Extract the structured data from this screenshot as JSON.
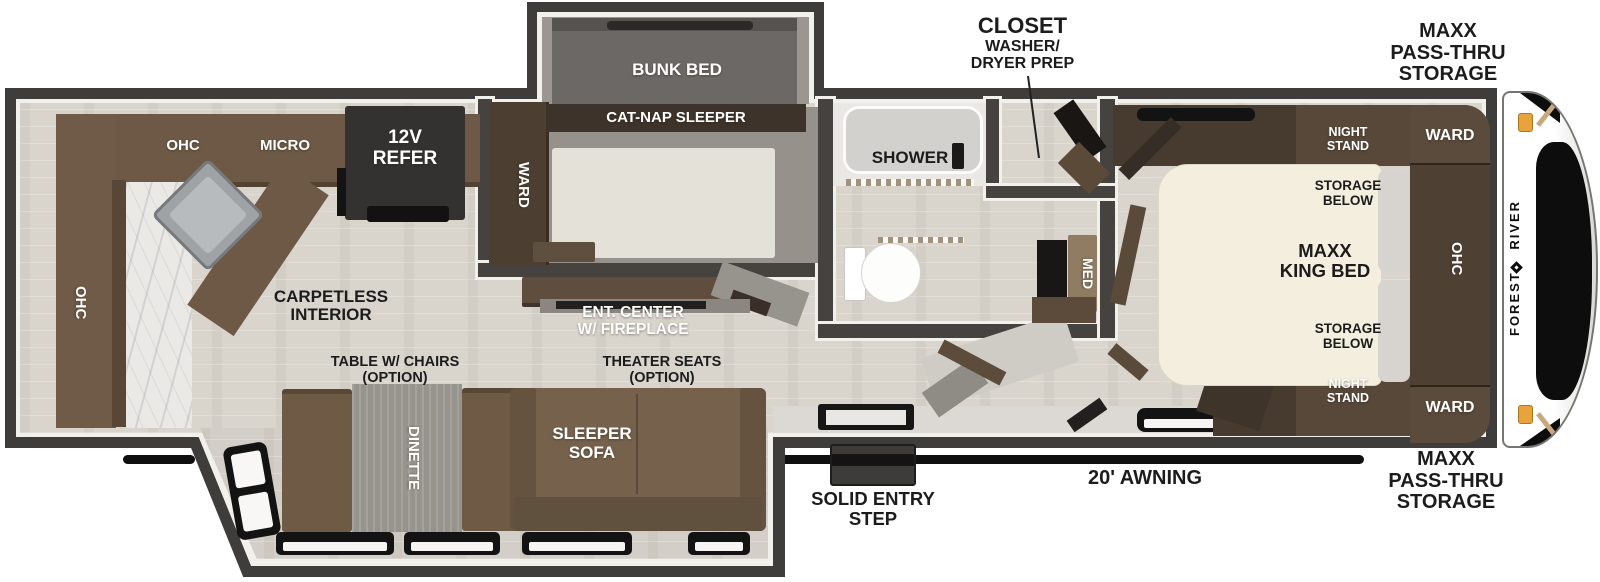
{
  "colors": {
    "wall": "#454240",
    "trim": "#f2f0ea",
    "floor": "#d9d5cd",
    "cabinet_brown": "#6d5946",
    "cabinet_dark_brown": "#4c3e31",
    "sofa_brown": "#75614c",
    "mattress_cream": "#f3eede",
    "table_gray": "#96948d",
    "marker_orange": "#e8a33c",
    "label_black": "#1c1c1c",
    "label_white": "#ffffff"
  },
  "brand": {
    "name": "FOREST RIVER"
  },
  "exterior": {
    "passthru_top": {
      "l1": "MAXX",
      "l2": "PASS-THRU",
      "l3": "STORAGE"
    },
    "passthru_bottom": {
      "l1": "MAXX",
      "l2": "PASS-THRU",
      "l3": "STORAGE"
    },
    "awning": "20' AWNING",
    "entry_step": {
      "l1": "SOLID ENTRY",
      "l2": "STEP"
    },
    "closet_callout": {
      "l1": "CLOSET",
      "l2": "WASHER/",
      "l3": "DRYER PREP"
    }
  },
  "kitchen": {
    "ohc_top": "OHC",
    "micro": "MICRO",
    "refer": {
      "l1": "12V",
      "l2": "REFER"
    },
    "ohc_side": "OHC"
  },
  "bunk_room": {
    "bunk_bed": "BUNK BED",
    "cat_nap": "CAT-NAP SLEEPER",
    "ward": "WARD"
  },
  "bath": {
    "shower": "SHOWER",
    "med": "MED"
  },
  "bedroom": {
    "night_stand_top": {
      "l1": "NIGHT",
      "l2": "STAND"
    },
    "night_stand_bottom": {
      "l1": "NIGHT",
      "l2": "STAND"
    },
    "storage_top": {
      "l1": "STORAGE",
      "l2": "BELOW"
    },
    "storage_bottom": {
      "l1": "STORAGE",
      "l2": "BELOW"
    },
    "king_bed": {
      "l1": "MAXX",
      "l2": "KING BED"
    },
    "ward_top": "WARD",
    "ward_bottom": "WARD",
    "ohc": "OHC"
  },
  "living": {
    "carpetless": {
      "l1": "CARPETLESS",
      "l2": "INTERIOR"
    },
    "ent_center": {
      "l1": "ENT. CENTER",
      "l2": "W/ FIREPLACE"
    },
    "table_chairs": {
      "l1": "TABLE W/ CHAIRS",
      "l2": "(OPTION)"
    },
    "theater_seats": {
      "l1": "THEATER SEATS",
      "l2": "(OPTION)"
    },
    "dinette": "DINETTE",
    "sleeper_sofa": {
      "l1": "SLEEPER",
      "l2": "SOFA"
    }
  }
}
